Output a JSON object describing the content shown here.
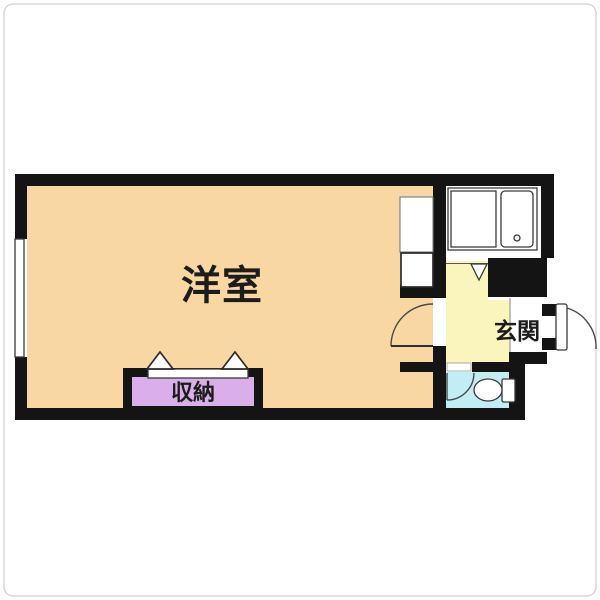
{
  "plan_title": "studio-apartment-floor-plan",
  "rooms": {
    "living": {
      "label": "洋室",
      "fill": "#F8D7A3"
    },
    "closet": {
      "label": "収納",
      "fill": "#D9AEE9"
    },
    "entrance": {
      "label": "玄関",
      "fill": "#FAF5BC"
    },
    "toilet": {
      "fill": "#C2EDF4"
    },
    "kitchen": {
      "fill": "#FFFFFF"
    }
  },
  "colors": {
    "wall": "#141414",
    "outline": "#3A3A3A",
    "label": "#1C1C1C",
    "frame": "#CFCFCF",
    "background": "#FFFFFF"
  }
}
